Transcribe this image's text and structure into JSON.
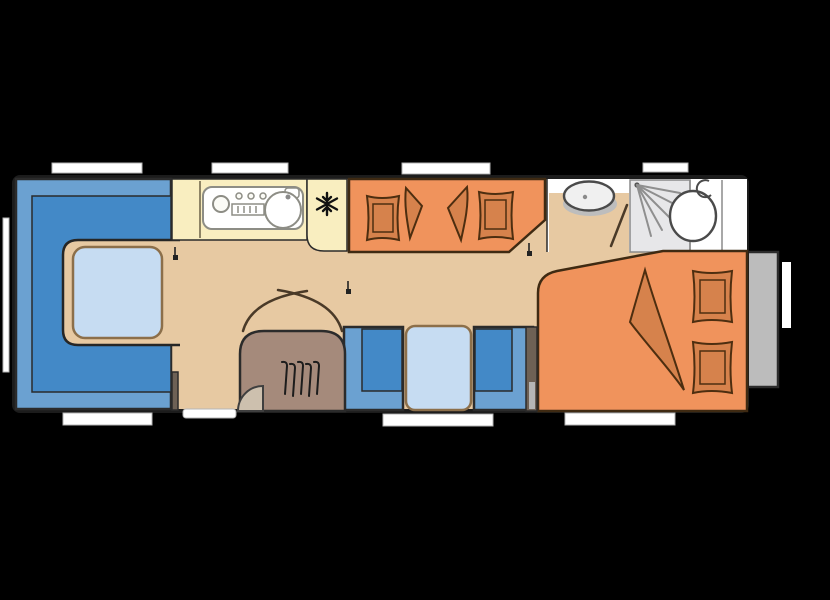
{
  "palette": {
    "background": "#000000",
    "floor_tan": "#e7c9a2",
    "seat_blue": "#6ba1d1",
    "seat_blue_dark": "#4389c7",
    "table_blue": "#c6dcf2",
    "kitchen_counter_yellow": "#f9eec0",
    "appliance_white": "#ffffff",
    "bed_orange": "#f0935c",
    "bedding_orange": "#d6824c",
    "wardrobe_brown": "#a58a7b",
    "entry_door_swing_tan": "#cdc0ae",
    "bathroom_white": "#ffffff",
    "shower_gray": "#e7e7e9",
    "basin_white": "#f0f0f0",
    "shadow_gray": "#bdbdbd",
    "exterior_box_gray": "#bcbcbc",
    "window_white": "#ffffff",
    "wall_stub_brown": "#6e6155",
    "wall_stub_light": "#b5b5b5",
    "burner_white": "#fbfbf6",
    "detail_gray": "#8a8a8a"
  },
  "floorplan": {
    "type": "caravan-floor-plan",
    "areas": [
      "front-dinette",
      "kitchen",
      "bunk-beds",
      "washbasin",
      "shower",
      "toilet",
      "rear-bed",
      "middle-dinette",
      "wardrobe",
      "entry-door"
    ],
    "icons": [
      "freezer-snowflake-icon",
      "shower-spray-icon",
      "hanger-icon"
    ],
    "windows": {
      "top": 4,
      "left": 1,
      "bottom": 3,
      "right": 1
    },
    "pillows": 4,
    "blankets": 3
  }
}
